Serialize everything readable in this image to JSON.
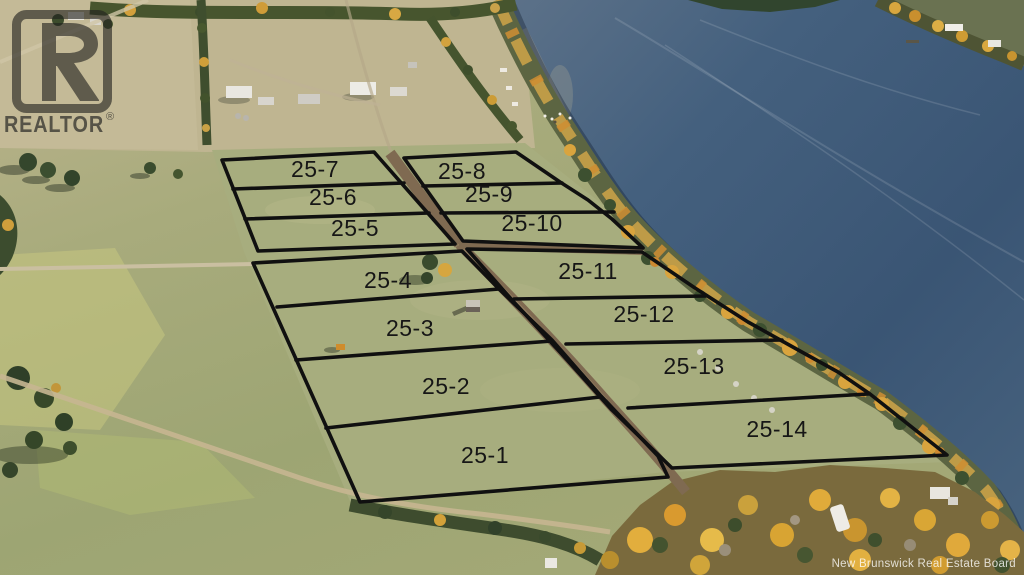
{
  "watermarks": {
    "realtor": {
      "name": "REALTOR",
      "registered": "®"
    },
    "board": "New Brunswick Real Estate Board"
  },
  "lots": [
    {
      "label": "25-1"
    },
    {
      "label": "25-2"
    },
    {
      "label": "25-3"
    },
    {
      "label": "25-4"
    },
    {
      "label": "25-5"
    },
    {
      "label": "25-6"
    },
    {
      "label": "25-7"
    },
    {
      "label": "25-8"
    },
    {
      "label": "25-9"
    },
    {
      "label": "25-10"
    },
    {
      "label": "25-11"
    },
    {
      "label": "25-12"
    },
    {
      "label": "25-13"
    },
    {
      "label": "25-14"
    }
  ],
  "colors": {
    "boundary": "#101010",
    "label": "#161616",
    "water_deep": "#3a5574",
    "water_light": "#5d7289",
    "grass": "#a6ad7c",
    "field": "#bdb492",
    "autumn": "#d9a43e",
    "road": "#7f6a51"
  }
}
